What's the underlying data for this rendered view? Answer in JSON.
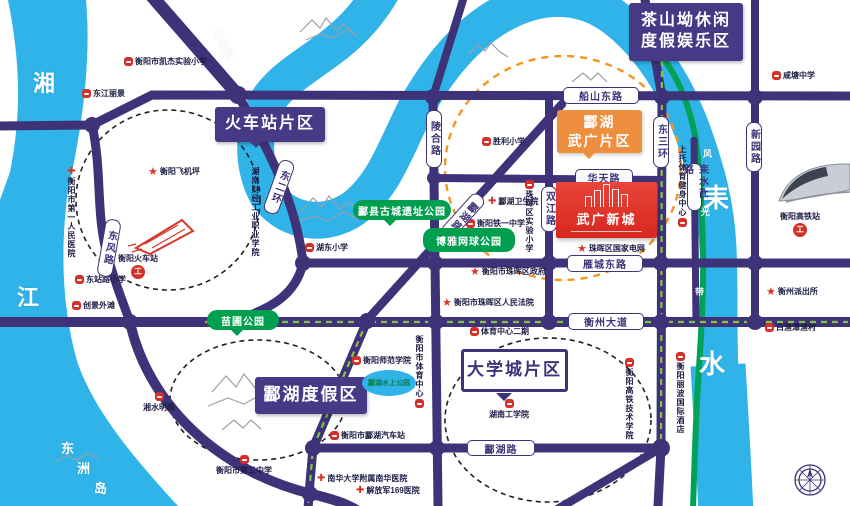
{
  "map": {
    "colors": {
      "road": "#3e3379",
      "river": "#2fb3e8",
      "greenway": "#00a258",
      "green_dash": "#86c440",
      "orange_zone": "#f7931e",
      "park_green": "#009e4f",
      "poi_red": "#d23028",
      "project_red": "#dd2c22"
    },
    "project": {
      "n": "wuguang-xincheng",
      "text": "武广新城",
      "x": 556,
      "y": 182,
      "w": 101,
      "h": 56
    },
    "area_boxes": [
      {
        "n": "zone-railway-station",
        "style": "purple",
        "x": 215,
        "y": 107,
        "w": 110,
        "h": 35,
        "lines": [
          "火车站片区"
        ],
        "ptr": "dl",
        "fs": 16
      },
      {
        "n": "zone-chashanao",
        "style": "purple",
        "x": 629,
        "y": 3,
        "w": 114,
        "h": 58,
        "lines": [
          "茶山坳休闲",
          "度假娱乐区"
        ],
        "fs": 16
      },
      {
        "n": "zone-linghu-resort",
        "style": "purple",
        "x": 255,
        "y": 377,
        "w": 112,
        "h": 37,
        "lines": [
          "酃湖度假区"
        ],
        "fs": 17
      },
      {
        "n": "zone-university-town",
        "style": "white",
        "x": 461,
        "y": 349,
        "w": 107,
        "h": 43,
        "lines": [
          "大学城片区"
        ],
        "ptr": "dl2",
        "fs": 17
      },
      {
        "n": "zone-linghu-wuguang",
        "style": "orange",
        "x": 557,
        "y": 110,
        "w": 85,
        "h": 43,
        "lines": [
          "酃湖",
          "武广片区"
        ],
        "ptr": "d",
        "fs": 14
      }
    ],
    "parks": [
      {
        "n": "park-miaopu",
        "text": "苗圃公园",
        "x": 207,
        "y": 310,
        "w": 72,
        "h": 20,
        "ptr": "d"
      },
      {
        "n": "park-ancient-city",
        "text": "酃县古城遗址公园",
        "x": 353,
        "y": 200,
        "w": 98,
        "h": 20,
        "ptr": "dl"
      },
      {
        "n": "park-boya-tennis",
        "text": "博雅网球公园",
        "x": 423,
        "y": 228,
        "w": 92,
        "h": 24
      }
    ],
    "lake": {
      "n": "linghu-water-park",
      "text": "酃湖水上公园",
      "x": 362,
      "y": 370,
      "w": 54,
      "h": 26
    },
    "road_pills": [
      {
        "n": "chuanshan-east-rd",
        "text": "船山东路",
        "x": 563,
        "y": 87,
        "w": 76,
        "h": 17
      },
      {
        "n": "huatian-rd",
        "text": "华天路",
        "x": 575,
        "y": 169,
        "w": 58,
        "h": 17
      },
      {
        "n": "yancheng-east-rd",
        "text": "雁城东路",
        "x": 567,
        "y": 255,
        "w": 76,
        "h": 17
      },
      {
        "n": "hengzhou-ave",
        "text": "衡州大道",
        "x": 568,
        "y": 313,
        "w": 76,
        "h": 17
      },
      {
        "n": "linghu-rd",
        "text": "酃湖路",
        "x": 467,
        "y": 440,
        "w": 68,
        "h": 16
      },
      {
        "n": "linghe-rd",
        "text": "陵合路",
        "x": 426,
        "y": 110,
        "w": 16,
        "h": 58,
        "v": 1
      },
      {
        "n": "shuangjiang-rd",
        "text": "双江路",
        "x": 541,
        "y": 186,
        "w": 16,
        "h": 46,
        "v": 1
      },
      {
        "n": "east-3rd-ring",
        "text": "东三环",
        "x": 653,
        "y": 116,
        "w": 16,
        "h": 52,
        "v": 1
      },
      {
        "n": "xinyuan-rd",
        "text": "新园路",
        "x": 746,
        "y": 122,
        "w": 16,
        "h": 50,
        "v": 1
      },
      {
        "n": "leishui-west-rd",
        "text": "耒水西路",
        "x": 687,
        "y": 163,
        "w": 15,
        "h": 48,
        "v": 1
      },
      {
        "n": "dongfeng-rd",
        "text": "东风路",
        "x": 101,
        "y": 219,
        "w": 16,
        "h": 58,
        "v": 1,
        "rot": 10
      },
      {
        "n": "east-2nd-ring",
        "text": "东二环",
        "x": 271,
        "y": 159,
        "w": 16,
        "h": 56,
        "v": 1,
        "rot": 20
      },
      {
        "n": "linghu-rd-diagonal",
        "text": "酃湖路",
        "x": 455,
        "y": 189,
        "w": 16,
        "h": 54,
        "v": 1,
        "rot": 42
      }
    ],
    "pois": [
      {
        "n": "school-kaijie",
        "t": "h",
        "x": 124,
        "y": 56,
        "text": "衡阳市凯杰实验小学"
      },
      {
        "n": "dongjiang-lijing",
        "t": "h",
        "x": 82,
        "y": 88,
        "text": "东江丽景"
      },
      {
        "n": "school-xiantang",
        "t": "h",
        "x": 772,
        "y": 70,
        "text": "咸塘中学"
      },
      {
        "n": "school-shengli",
        "t": "h",
        "x": 482,
        "y": 136,
        "text": "胜利小学"
      },
      {
        "n": "hospital-linghu",
        "t": "hx",
        "x": 488,
        "y": 196,
        "text": "酃湖卫生院"
      },
      {
        "n": "school-tieyi",
        "t": "h",
        "x": 466,
        "y": 218,
        "text": "衡阳铁一中学"
      },
      {
        "n": "school-zhuhui-shiyan",
        "t": "v",
        "x": 524,
        "y": 180,
        "text": "珠晖区实验小学"
      },
      {
        "n": "school-hudong",
        "t": "h",
        "x": 305,
        "y": 242,
        "text": "湖东小学"
      },
      {
        "n": "gov-zhuhui-district",
        "t": "star",
        "x": 470,
        "y": 266,
        "text": "衡阳市珠晖区政府"
      },
      {
        "n": "court-zhuhui",
        "t": "star",
        "x": 442,
        "y": 297,
        "text": "衡阳市珠晖区人民法院"
      },
      {
        "n": "state-grid-zhuhui",
        "t": "star",
        "x": 577,
        "y": 243,
        "text": "珠晖区国家电网"
      },
      {
        "n": "police-hengzhou",
        "t": "star",
        "x": 766,
        "y": 286,
        "text": "衡州派出所"
      },
      {
        "n": "baiyutan-fishing-village",
        "t": "h",
        "x": 765,
        "y": 322,
        "text": "白渔潭渔村"
      },
      {
        "n": "hospital-first-people",
        "t": "vx",
        "x": 66,
        "y": 167,
        "text": "衡阳市第一人民医院"
      },
      {
        "n": "hengyang-airstrip",
        "t": "star",
        "x": 148,
        "y": 166,
        "text": "衡阳飞机坪"
      },
      {
        "n": "finance-industry-college",
        "t": "pv",
        "x": 250,
        "y": 167,
        "text": "湖南财经工业职业学院"
      },
      {
        "n": "school-dongzhanlu",
        "t": "h",
        "x": 75,
        "y": 274,
        "text": "东站路小学"
      },
      {
        "n": "chuangjing-waitan",
        "t": "h",
        "x": 72,
        "y": 300,
        "text": "创景外滩"
      },
      {
        "n": "hengyang-railway-station",
        "t": "st",
        "x": 118,
        "y": 253,
        "text": "衡阳火车站"
      },
      {
        "n": "hengyang-normal-university",
        "t": "h",
        "x": 352,
        "y": 355,
        "text": "衡阳师范学院"
      },
      {
        "n": "city-sports-center",
        "t": "vb",
        "x": 414,
        "y": 335,
        "text": "衡阳市体育中心"
      },
      {
        "n": "sports-center-phase2",
        "t": "h",
        "x": 470,
        "y": 326,
        "text": "体育中心二期"
      },
      {
        "n": "hunan-institute-of-technology",
        "t": "tb",
        "x": 489,
        "y": 399,
        "text": "湖南工学院"
      },
      {
        "n": "linghu-bus-station",
        "t": "h",
        "x": 330,
        "y": 430,
        "text": "衡阳市酃湖汽车站"
      },
      {
        "n": "nanhua-university-hospital",
        "t": "hx",
        "x": 317,
        "y": 473,
        "text": "南华大学附属南华医院"
      },
      {
        "n": "pla-169-hospital",
        "t": "hx",
        "x": 356,
        "y": 485,
        "text": "解放军169医院"
      },
      {
        "n": "no3-middle-school",
        "t": "tb",
        "x": 216,
        "y": 455,
        "text": "衡阳市第三中学"
      },
      {
        "n": "xiangshui-mingzhu",
        "t": "tb",
        "x": 143,
        "y": 392,
        "text": "湘水明珠"
      },
      {
        "n": "hsr-tech-college",
        "t": "v",
        "x": 624,
        "y": 358,
        "text": "衡阳高铁技术学院"
      },
      {
        "n": "libo-international-hotel",
        "t": "v",
        "x": 675,
        "y": 352,
        "text": "衡阳丽波国际酒店"
      },
      {
        "n": "shangtuo-fitness-center",
        "t": "vb",
        "x": 677,
        "y": 145,
        "text": "上托体育健身中心"
      },
      {
        "n": "hengyang-hsr-station",
        "t": "st",
        "x": 780,
        "y": 211,
        "text": "衡阳高铁站"
      }
    ],
    "river_labels": [
      {
        "n": "xiangjiang-char1",
        "text": "湘",
        "x": 33,
        "y": 66,
        "s": 22
      },
      {
        "n": "xiangjiang-char2",
        "text": "江",
        "x": 17,
        "y": 280,
        "s": 22
      },
      {
        "n": "dongzhou-island-char1",
        "text": "东",
        "x": 61,
        "y": 438,
        "s": 13
      },
      {
        "n": "dongzhou-island-char2",
        "text": "洲",
        "x": 77,
        "y": 458,
        "s": 13
      },
      {
        "n": "dongzhou-island-char3",
        "text": "岛",
        "x": 94,
        "y": 478,
        "s": 13
      },
      {
        "n": "leishui-char1",
        "text": "耒",
        "x": 703,
        "y": 178,
        "s": 26
      },
      {
        "n": "leishui-char2",
        "text": "水",
        "x": 699,
        "y": 344,
        "s": 26
      },
      {
        "n": "leishui-river",
        "text": "耒水河",
        "x": 207,
        "y": 36,
        "s": 11,
        "rot": 62
      },
      {
        "n": "scenic-belt-char1",
        "text": "风",
        "x": 703,
        "y": 147,
        "s": 9
      },
      {
        "n": "scenic-belt-char2",
        "text": "光",
        "x": 701,
        "y": 205,
        "s": 9
      },
      {
        "n": "scenic-belt-char3",
        "text": "带",
        "x": 695,
        "y": 285,
        "s": 9
      }
    ]
  }
}
